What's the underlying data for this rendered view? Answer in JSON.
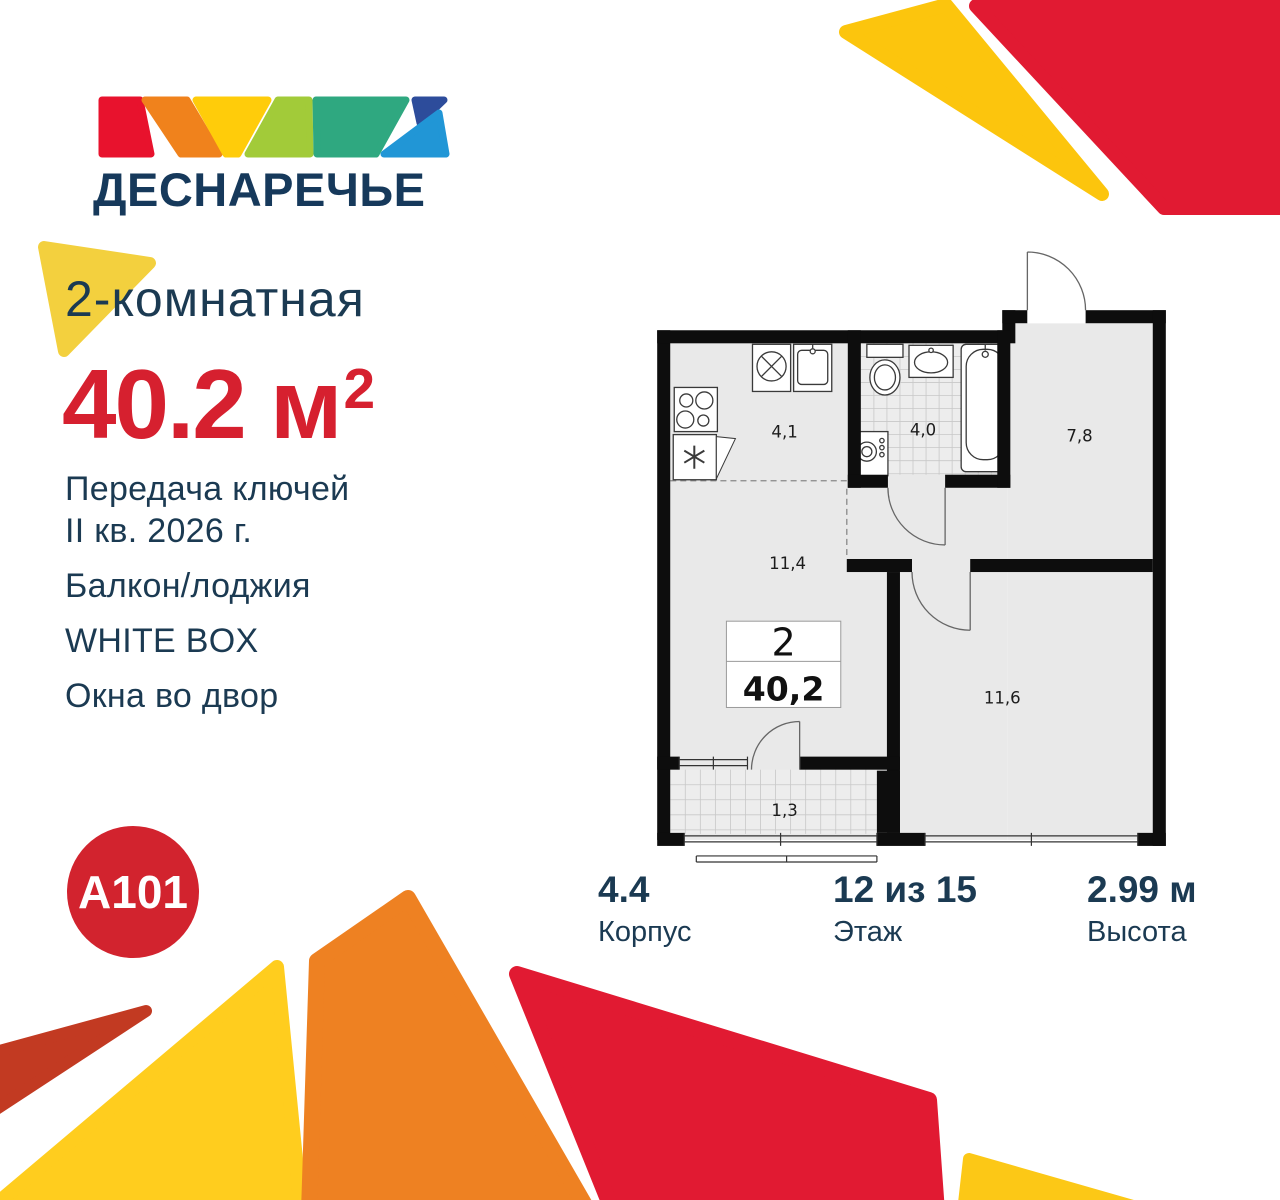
{
  "logo": {
    "title": "ДЕСНАРЕЧЬЕ"
  },
  "listing": {
    "type_title": "2-комнатная",
    "area_value": "40.2 м",
    "area_sup": "2",
    "features": [
      {
        "lines": [
          "Передача ключей",
          "II кв. 2026 г."
        ]
      },
      {
        "lines": [
          "Балкон/лоджия"
        ]
      },
      {
        "lines": [
          "WHITE BOX"
        ]
      },
      {
        "lines": [
          "Окна во двор"
        ]
      }
    ]
  },
  "plan": {
    "badge": {
      "rooms": "2",
      "area": "40,2"
    },
    "areas": {
      "kitchen": "4,1",
      "bathroom": "4,0",
      "hall": "7,8",
      "living": "11,4",
      "bedroom": "11,6",
      "balcony": "1,3"
    }
  },
  "stats": [
    {
      "value": "4.4",
      "label": "Корпус"
    },
    {
      "value": "12 из 15",
      "label": "Этаж"
    },
    {
      "value": "2.99 м",
      "label": "Высота"
    }
  ],
  "developer": {
    "logo_text": "A101"
  },
  "colors": {
    "navy": "#1B3A52",
    "accent_red": "#D6202F",
    "brand_red": "#D2232E",
    "decor_red": "#E11A32",
    "decor_orange": "#EE8122",
    "decor_yellow": "#FFCD1E",
    "decor_brick": "#C23A22"
  }
}
